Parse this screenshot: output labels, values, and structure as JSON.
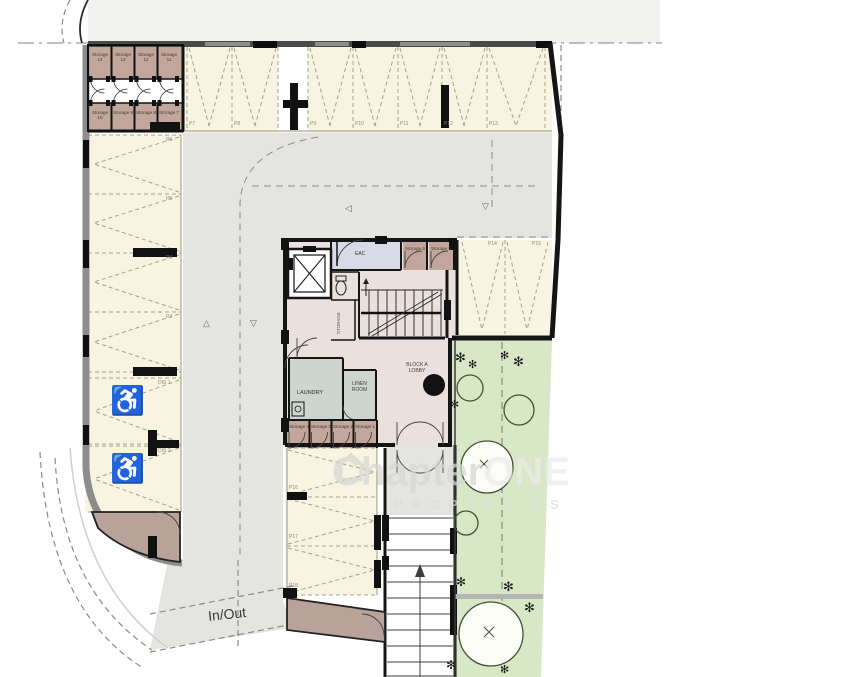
{
  "plan": {
    "watermark": {
      "brand_bold": "Chapter",
      "brand_accent": "ONE",
      "subtitle": "PROPERTIES"
    },
    "labels": {
      "in_out": "In/Out"
    },
    "rooms": {
      "eac": "EAC",
      "laundry": "LAUNDRY",
      "linen": "LINEN ROOM",
      "lobby": "BLOCK A LOBBY",
      "store": "STORAGE"
    },
    "storage_block": {
      "row1": [
        "Storage 14",
        "Storage 13",
        "Storage 12",
        "Storage 11"
      ],
      "row2": [
        "Storage 10",
        "Storage 9",
        "Storage 8",
        "Storage 7"
      ]
    },
    "core_storages_top": [
      "Storage 6",
      "Storage 5"
    ],
    "core_storages_bottom": [
      "Storage 4",
      "Storage 3",
      "Storage 2",
      "Storage 1"
    ],
    "parking": {
      "top": [
        "P7",
        "P8",
        "P9",
        "P10",
        "P11",
        "P12",
        "P13"
      ],
      "left": [
        "P6",
        "P5",
        "P4",
        "P3"
      ],
      "accessible": [
        "DIS 1",
        "DIS 2"
      ],
      "right": [
        "P14",
        "P15"
      ],
      "bottom": [
        "P16",
        "P17",
        "P18"
      ]
    },
    "icons": {
      "wheelchair": "♿",
      "shrub": "✻",
      "tri_left": "◁",
      "tri_down": "▽",
      "tri_up": "△"
    },
    "colors": {
      "parking_fill": "#f7f5e1",
      "storage_fill": "#c2a69b",
      "aisle_fill": "#e4e4e1",
      "core_fill": "#eae1dc",
      "laundry_fill": "#ccd5ce",
      "eac_fill": "#d9dae8",
      "garden_fill": "#d8e8c7",
      "wall": "#151515"
    }
  }
}
